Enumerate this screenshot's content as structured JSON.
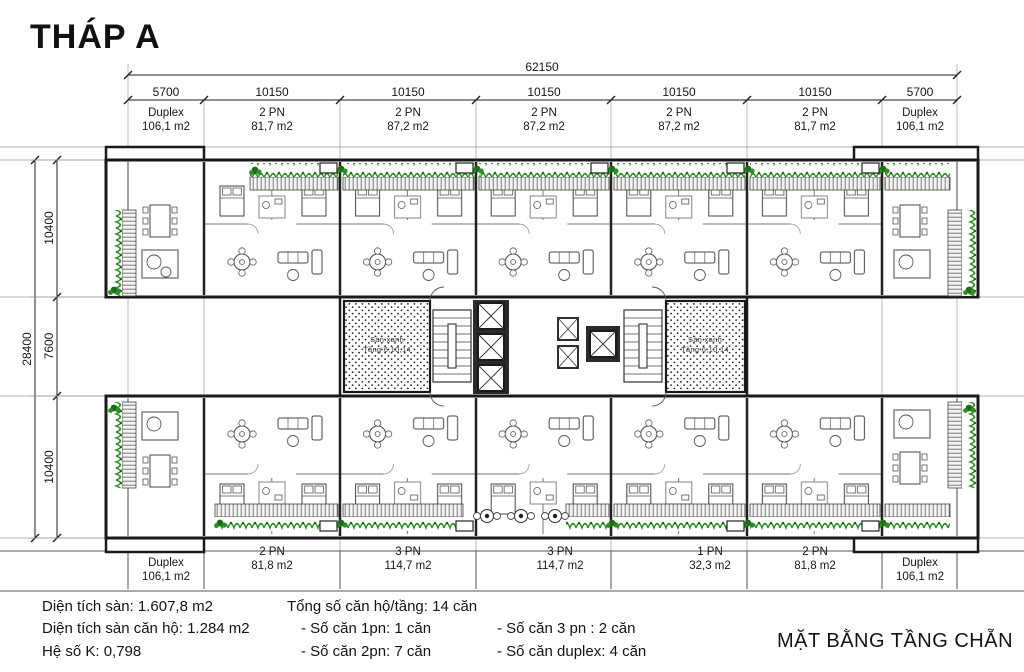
{
  "title": "THÁP A",
  "plan_caption": "MẶT BẰNG TẦNG CHẴN",
  "dimensions": {
    "overall_width": "62150",
    "width_segments": [
      "5700",
      "10150",
      "10150",
      "10150",
      "10150",
      "10150",
      "5700"
    ],
    "overall_depth": "28400",
    "depth_segments": [
      "10400",
      "7600",
      "10400"
    ]
  },
  "top_units": [
    {
      "type": "Duplex",
      "area": "106,1 m2"
    },
    {
      "type": "2 PN",
      "area": "81,7 m2"
    },
    {
      "type": "2 PN",
      "area": "87,2 m2"
    },
    {
      "type": "2 PN",
      "area": "87,2 m2"
    },
    {
      "type": "2 PN",
      "area": "87,2 m2"
    },
    {
      "type": "2 PN",
      "area": "81,7 m2"
    },
    {
      "type": "Duplex",
      "area": "106,1 m2"
    }
  ],
  "bottom_units": [
    {
      "type": "Duplex",
      "area": "106,1 m2"
    },
    {
      "type": "2 PN",
      "area": "81,8 m2"
    },
    {
      "type": "3 PN",
      "area": "114,7 m2"
    },
    {
      "type": "3 PN",
      "area": "114,7 m2"
    },
    {
      "type": "1 PN",
      "area": "32,3 m2"
    },
    {
      "type": "2 PN",
      "area": "81,8 m2"
    },
    {
      "type": "Duplex",
      "area": "106,1 m2"
    }
  ],
  "core": {
    "green_floor_left": {
      "line1": "Sàn xanh",
      "line2": "Tầng 6,10,14"
    },
    "green_floor_right": {
      "line1": "Sàn xanh",
      "line2": "Tầng 6,10,14"
    }
  },
  "summary": {
    "floor_area": "Diện tích sàn: 1.607,8 m2",
    "unit_floor_area": "Diện tích sàn căn hộ: 1.284 m2",
    "k_factor": "Hệ số K: 0,798",
    "total_units": "Tổng số căn hộ/tầng: 14 căn",
    "one_bedroom": "- Số căn 1pn: 1 căn",
    "two_bedroom": "- Số căn 2pn: 7 căn",
    "three_bedroom": "- Số căn 3 pn   : 2 căn",
    "duplex_count": "- Số căn duplex: 4 căn"
  },
  "colors": {
    "wall": "#1a1a1a",
    "green": "#2e8b27",
    "green_dark": "#1d6b18"
  }
}
